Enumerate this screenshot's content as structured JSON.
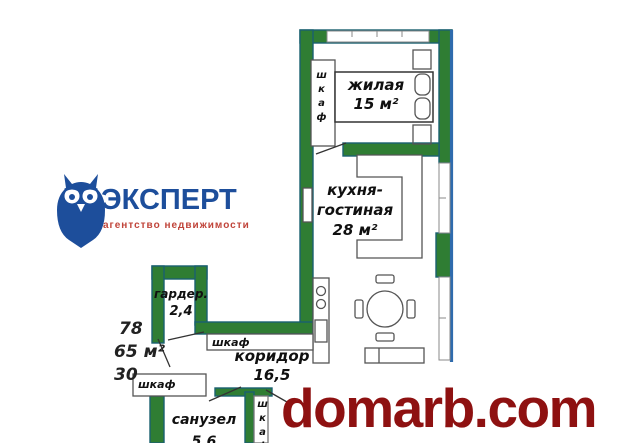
{
  "logo": {
    "title": "ЭКСПЕРТ",
    "tagline": "агентство недвижимости"
  },
  "rooms": {
    "living": {
      "name": "жилая",
      "area": "15 м²"
    },
    "kitchen": {
      "line1": "кухня-",
      "line2": "гостиная",
      "area": "28 м²"
    },
    "wardrobe": {
      "name": "гардер.",
      "area": "2,4"
    },
    "corridor": {
      "name": "коридор",
      "area": "16,5"
    },
    "bathroom": {
      "name": "санузел",
      "area": "5,6"
    }
  },
  "closets": {
    "bedroom": "шкаф",
    "hallway": "шкаф",
    "entry": "шкаф",
    "bathroom": "шкаф"
  },
  "side_figures": {
    "line1": "78",
    "line2": "65 м²",
    "line3": "30"
  },
  "watermark": "domarb.com",
  "colors": {
    "wall_green": "#2f7d33",
    "wall_outline": "#1a6070",
    "exterior_blue": "#2f6bad",
    "logo_blue": "#1d4e9b",
    "logo_red": "#c0443a",
    "watermark_red": "#8e1111"
  }
}
